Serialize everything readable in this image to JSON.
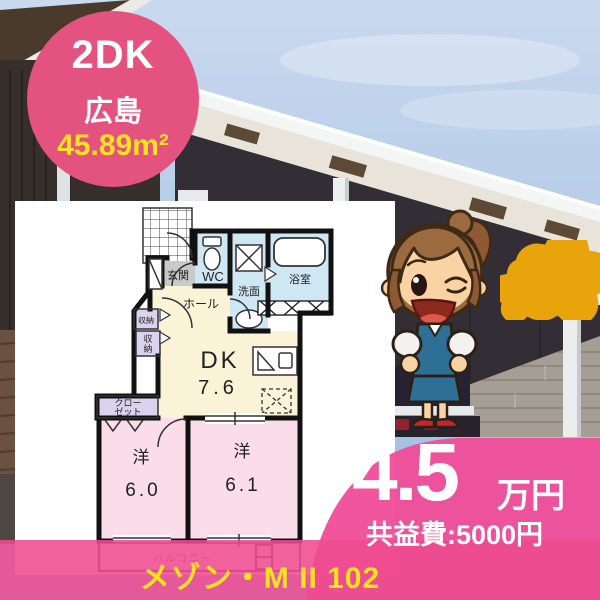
{
  "badge": {
    "layout": "2DK",
    "location": "広島",
    "area": "45.89m²"
  },
  "price": {
    "amount": "4.5",
    "unit": "万円",
    "fee_label": "共益費:5000円"
  },
  "footer": {
    "property_name": "メゾン・M II 102"
  },
  "floor_plan": {
    "rooms": {
      "entrance": "玄関",
      "wc": "WC",
      "washroom": "洗面",
      "bathroom": "浴室",
      "hall": "ホール",
      "storage_a": "収納",
      "storage_b_l1": "収",
      "storage_b_l2": "納",
      "dk_label": "DK",
      "dk_size": "7.6",
      "closet_l1": "クロー",
      "closet_l2": "ゼット",
      "room1_label": "洋",
      "room1_size": "6.0",
      "room2_label": "洋",
      "room2_size": "6.1",
      "balcony": "バルコニー"
    },
    "colors": {
      "water": "#cfe7f3",
      "living": "#faf3d7",
      "bedroom": "#fadde9",
      "storage": "#dad2ef",
      "entrance_floor": "#c9c9c9"
    }
  },
  "colors": {
    "brand_pink": "#e4537f",
    "banner_pink": "#f0509a",
    "band_pink": "#ee4b90",
    "accent_yellow": "#ffe31c",
    "star_yellow": "#ffd400"
  },
  "mascot": {
    "name": "winking-estate-agent-mascot"
  }
}
